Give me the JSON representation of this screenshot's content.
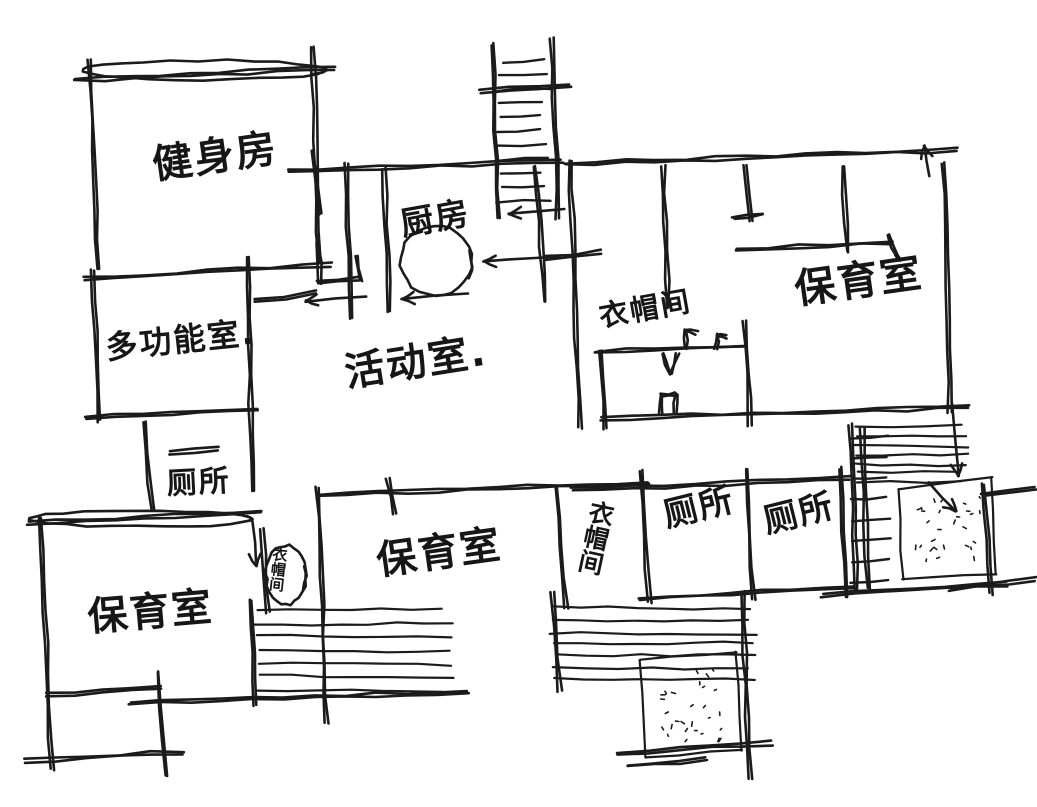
{
  "drawing": {
    "kind": "hand-drawn floor plan sketch",
    "ink_color": "#1b1b1b",
    "background_color": "#ffffff",
    "width": 1037,
    "height": 807
  },
  "labels": [
    {
      "id": "gym",
      "text": "健身房",
      "x": 150,
      "y": 146,
      "size": 40,
      "rot": -8,
      "vertical": false
    },
    {
      "id": "kitchen",
      "text": "厨房",
      "x": 398,
      "y": 208,
      "size": 33,
      "rot": -10,
      "vertical": false
    },
    {
      "id": "nursery-right",
      "text": "保育室",
      "x": 792,
      "y": 270,
      "size": 41,
      "rot": -8,
      "vertical": false
    },
    {
      "id": "multi-function",
      "text": "多功能室.",
      "x": 104,
      "y": 332,
      "size": 32,
      "rot": -6,
      "vertical": false
    },
    {
      "id": "activity",
      "text": "活动室.",
      "x": 342,
      "y": 354,
      "size": 40,
      "rot": -9,
      "vertical": false
    },
    {
      "id": "toilet-upper",
      "text": "厕所",
      "x": 166,
      "y": 470,
      "size": 30,
      "rot": -3,
      "vertical": false
    },
    {
      "id": "cloakroom-upper",
      "text": "衣帽间",
      "x": 597,
      "y": 303,
      "size": 29,
      "rot": -10,
      "vertical": false
    },
    {
      "id": "cloakroom-middle",
      "text": "衣帽间",
      "x": 590,
      "y": 498,
      "size": 25,
      "rot": 12,
      "vertical": true
    },
    {
      "id": "toilet-left",
      "text": "厕所",
      "x": 660,
      "y": 500,
      "size": 34,
      "rot": -14,
      "vertical": false
    },
    {
      "id": "toilet-right",
      "text": "厕所",
      "x": 760,
      "y": 506,
      "size": 34,
      "rot": -14,
      "vertical": false
    },
    {
      "id": "nursery-middle",
      "text": "保育室",
      "x": 374,
      "y": 542,
      "size": 40,
      "rot": -8,
      "vertical": false
    },
    {
      "id": "nursery-left",
      "text": "保育室",
      "x": 86,
      "y": 598,
      "size": 40,
      "rot": -5,
      "vertical": false
    },
    {
      "id": "cloakroom-small",
      "text": "衣帽间",
      "x": 272,
      "y": 546,
      "size": 15,
      "rot": 6,
      "vertical": true
    }
  ],
  "sketch": {
    "walls": [
      [
        75,
        80,
        335,
        68
      ],
      [
        90,
        60,
        98,
        270
      ],
      [
        313,
        46,
        319,
        262
      ],
      [
        85,
        279,
        332,
        265
      ],
      [
        93,
        270,
        100,
        421
      ],
      [
        247,
        257,
        253,
        492
      ],
      [
        86,
        418,
        258,
        409
      ],
      [
        145,
        423,
        152,
        512
      ],
      [
        170,
        453,
        218,
        448
      ],
      [
        28,
        523,
        262,
        512
      ],
      [
        40,
        517,
        52,
        770
      ],
      [
        24,
        761,
        183,
        752
      ],
      [
        46,
        695,
        162,
        688
      ],
      [
        158,
        672,
        166,
        776
      ],
      [
        288,
        171,
        562,
        161
      ],
      [
        346,
        164,
        352,
        318
      ],
      [
        384,
        168,
        390,
        312
      ],
      [
        535,
        166,
        545,
        302
      ],
      [
        255,
        301,
        315,
        293
      ],
      [
        312,
        150,
        320,
        214
      ],
      [
        318,
        243,
        320,
        284
      ],
      [
        318,
        283,
        360,
        279
      ],
      [
        357,
        256,
        360,
        280
      ],
      [
        480,
        91,
        570,
        85
      ],
      [
        565,
        164,
        957,
        150
      ],
      [
        570,
        160,
        580,
        428
      ],
      [
        944,
        163,
        950,
        412
      ],
      [
        663,
        166,
        668,
        308
      ],
      [
        746,
        166,
        751,
        222
      ],
      [
        745,
        320,
        750,
        425
      ],
      [
        733,
        219,
        763,
        214
      ],
      [
        843,
        166,
        848,
        252
      ],
      [
        736,
        250,
        893,
        242
      ],
      [
        888,
        234,
        898,
        260
      ],
      [
        596,
        352,
        746,
        346
      ],
      [
        599,
        351,
        606,
        428
      ],
      [
        663,
        353,
        670,
        374
      ],
      [
        670,
        374,
        678,
        353
      ],
      [
        685,
        348,
        686,
        331
      ],
      [
        686,
        331,
        697,
        333
      ],
      [
        716,
        348,
        717,
        335
      ],
      [
        717,
        335,
        726,
        337
      ],
      [
        660,
        396,
        676,
        394
      ],
      [
        661,
        396,
        661,
        414
      ],
      [
        676,
        394,
        676,
        413
      ],
      [
        600,
        419,
        968,
        407
      ],
      [
        545,
        258,
        601,
        252
      ],
      [
        850,
        425,
        857,
        590
      ],
      [
        862,
        428,
        868,
        588
      ],
      [
        984,
        484,
        992,
        594
      ],
      [
        822,
        595,
        1006,
        584
      ],
      [
        950,
        589,
        1036,
        579
      ],
      [
        982,
        496,
        1036,
        489
      ],
      [
        318,
        495,
        648,
        483
      ],
      [
        572,
        490,
        850,
        478
      ],
      [
        556,
        487,
        566,
        608
      ],
      [
        641,
        471,
        649,
        602
      ],
      [
        746,
        470,
        753,
        600
      ],
      [
        840,
        468,
        847,
        596
      ],
      [
        640,
        599,
        853,
        587
      ],
      [
        318,
        488,
        326,
        724
      ],
      [
        388,
        478,
        394,
        514
      ],
      [
        250,
        600,
        256,
        706
      ],
      [
        130,
        703,
        468,
        692
      ],
      [
        552,
        592,
        560,
        692
      ],
      [
        742,
        592,
        750,
        778
      ],
      [
        618,
        753,
        772,
        743
      ],
      [
        628,
        766,
        706,
        759
      ],
      [
        262,
        528,
        268,
        612
      ]
    ],
    "ellipses": [
      {
        "cx": 205,
        "cy": 70,
        "rx": 122,
        "ry": 10
      },
      {
        "cx": 140,
        "cy": 519,
        "rx": 112,
        "ry": 8
      },
      {
        "cx": 436,
        "cy": 261,
        "rx": 36,
        "ry": 35
      },
      {
        "cx": 286,
        "cy": 575,
        "rx": 20,
        "ry": 30
      }
    ],
    "stairs": {
      "rail1": [
        492,
        44,
        498,
        218
      ],
      "rail2": [
        552,
        38,
        558,
        218
      ],
      "rungs": 11,
      "ytop": 62,
      "ybot": 202,
      "xa": 496,
      "xb": 550
    },
    "ladder": {
      "x1": 850,
      "x2": 892,
      "ytop": 438,
      "ybot": 582,
      "n": 8
    },
    "hatches": [
      {
        "x": 852,
        "y": 424,
        "w": 118,
        "h": 64,
        "n": 7
      },
      {
        "x": 254,
        "y": 606,
        "w": 202,
        "h": 92,
        "n": 7
      },
      {
        "x": 550,
        "y": 604,
        "w": 210,
        "h": 84,
        "n": 7
      }
    ],
    "stipples": [
      {
        "quad": [
          [
            898,
            489
          ],
          [
            992,
            477
          ],
          [
            996,
            574
          ],
          [
            903,
            580
          ]
        ],
        "n": 28
      },
      {
        "quad": [
          [
            640,
            660
          ],
          [
            736,
            652
          ],
          [
            742,
            750
          ],
          [
            646,
            757
          ]
        ],
        "n": 28
      }
    ],
    "arrows": [
      [
        468,
        293,
        402,
        299
      ],
      [
        366,
        296,
        306,
        301
      ],
      [
        560,
        256,
        484,
        262
      ],
      [
        565,
        209,
        509,
        214
      ],
      [
        952,
        404,
        958,
        476
      ],
      [
        928,
        483,
        956,
        511
      ],
      [
        253,
        518,
        256,
        566
      ],
      [
        930,
        176,
        924,
        146
      ]
    ]
  }
}
